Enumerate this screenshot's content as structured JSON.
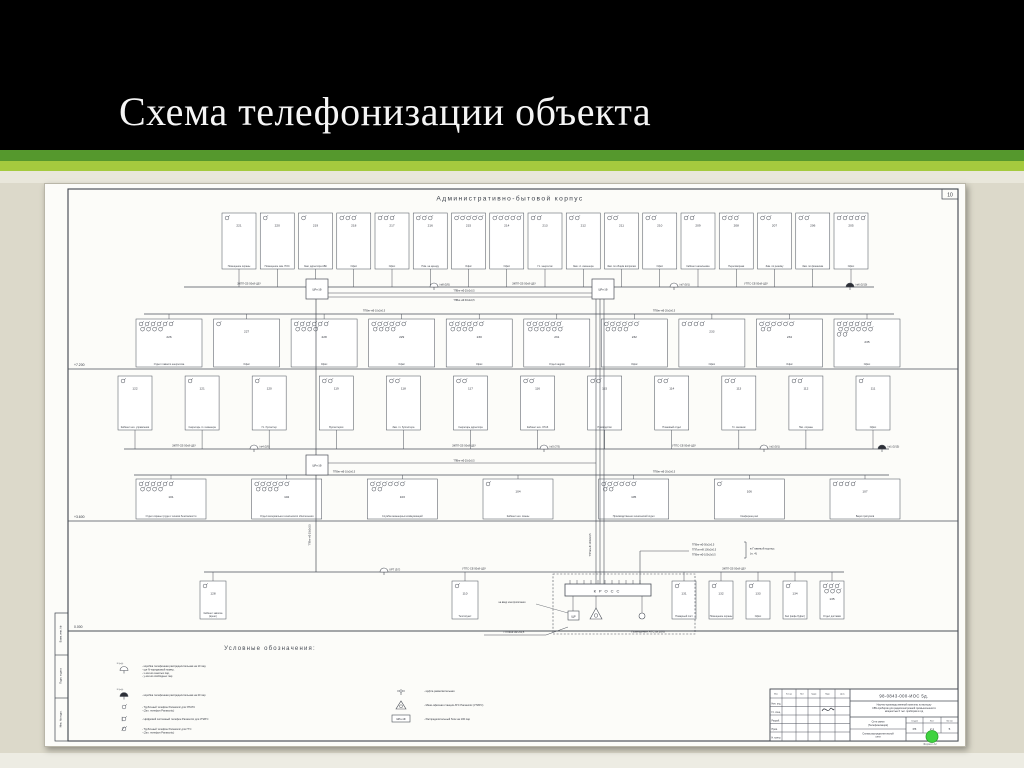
{
  "slide": {
    "title": "Схема телефонизации объекта"
  },
  "colors": {
    "header_bg": "#000000",
    "stripe_dark": "#55982d",
    "stripe_light": "#a5ca3e",
    "slide_bg": "#dcd9ca",
    "sheet_bg": "#fcfcf9",
    "line": "#474d56",
    "logo_green": "#3fd23f"
  },
  "sheet": {
    "corner_number": "10",
    "building_title": "Административно-бытовой корпус",
    "levels": [
      "+7.200",
      "+3.600",
      "0.000"
    ],
    "risers": {
      "cabinet": "ШРн-1Ф",
      "cable_left": "ТПВнг-нФ 30х2х0,5",
      "cable_center": "ТППэп-нФ 100х2х0,5",
      "floor_links": [
        "ТПВнг-нФ 20х2х0,5",
        "ТПВнг-нФ 30х2х0,5"
      ]
    },
    "floor2": {
      "row_top": [
        {
          "num": "221",
          "label": "Помещение охраны",
          "phones": 1
        },
        {
          "num": "220",
          "label": "Помещение зам. НОС",
          "phones": 1
        },
        {
          "num": "219",
          "label": "Зам. директора АБК",
          "phones": 1
        },
        {
          "num": "218",
          "label": "Офис",
          "phones": 3
        },
        {
          "num": "217",
          "label": "Офис",
          "phones": 3
        },
        {
          "num": "216",
          "label": "Пом. на аренду",
          "phones": 3
        },
        {
          "num": "215",
          "label": "Офис",
          "phones": 5
        },
        {
          "num": "214",
          "label": "Офис",
          "phones": 5
        },
        {
          "num": "213",
          "label": "Гл. энергетик",
          "phones": 2
        },
        {
          "num": "212",
          "label": "Зам. гл. инженера",
          "phones": 2
        },
        {
          "num": "211",
          "label": "Зам. по общим вопросам",
          "phones": 2
        },
        {
          "num": "210",
          "label": "Офис",
          "phones": 2
        },
        {
          "num": "209",
          "label": "Кабинет начальника",
          "phones": 2
        },
        {
          "num": "208",
          "label": "Переговорная",
          "phones": 3
        },
        {
          "num": "207",
          "label": "Зам. по режиму",
          "phones": 2
        },
        {
          "num": "206",
          "label": "Зам. по финансам",
          "phones": 2
        },
        {
          "num": "205",
          "label": "Офис",
          "phones": 5
        }
      ],
      "row_bottom": [
        {
          "num": "226",
          "label": "Отдел главного энергетика",
          "phones": 10
        },
        {
          "num": "227",
          "label": "Офис",
          "phones": 1
        },
        {
          "num": "228",
          "label": "Офис",
          "phones": 10
        },
        {
          "num": "229",
          "label": "Офис",
          "phones": 10
        },
        {
          "num": "230",
          "label": "Офис",
          "phones": 10
        },
        {
          "num": "231",
          "label": "Отдел кадров",
          "phones": 12
        },
        {
          "num": "232",
          "label": "Офис",
          "phones": 10
        },
        {
          "num": "233",
          "label": "Офис",
          "phones": 4
        },
        {
          "num": "234",
          "label": "Офис",
          "phones": 8
        },
        {
          "num": "235",
          "label": "Офис",
          "phones": 14
        }
      ],
      "taps": [
        "№8 (5/5)",
        "№7 (9/1)",
        "№6 (5/10)"
      ],
      "bus_labels": [
        "ЗКПП-СЕ-50х8-ЦЗУ",
        "ЗКПП-СЕ-50х8-ЦЗУ",
        "УТПС-СЕ-50х8-ЦЗУ"
      ],
      "feeder_labels": [
        "ТПВнг-нФ 10х2х0,5",
        "ТПВнг-нФ 20х2х0,5"
      ]
    },
    "floor1": {
      "row_top": [
        {
          "num": "122",
          "label": "Кабинет нач. управления",
          "phones": 1
        },
        {
          "num": "121",
          "label": "Секретарь гл. инженера",
          "phones": 1
        },
        {
          "num": "120",
          "label": "Гл. бухгалтер",
          "phones": 1
        },
        {
          "num": "119",
          "label": "Бухгалтерия",
          "phones": 2
        },
        {
          "num": "118",
          "label": "Зам. гл. бухгалтера",
          "phones": 2
        },
        {
          "num": "117",
          "label": "Секретарь директора",
          "phones": 2
        },
        {
          "num": "116",
          "label": "Кабинет нач. ОТиЗ",
          "phones": 2
        },
        {
          "num": "115",
          "label": "Руководство",
          "phones": 2
        },
        {
          "num": "114",
          "label": "Плановый отдел",
          "phones": 2
        },
        {
          "num": "113",
          "label": "Гл. механик",
          "phones": 2
        },
        {
          "num": "112",
          "label": "Нач. охраны",
          "phones": 2
        },
        {
          "num": "111",
          "label": "Офис",
          "phones": 1
        }
      ],
      "row_bottom": [
        {
          "num": "101",
          "label": "Отдел охраны труда и техники безопасности",
          "phones": 10
        },
        {
          "num": "102",
          "label": "Отдел материально-технического обеспечения",
          "phones": 10
        },
        {
          "num": "103",
          "label": "Служба инженерных коммуникаций",
          "phones": 8
        },
        {
          "num": "104",
          "label": "Кабинет нач. смены",
          "phones": 1
        },
        {
          "num": "105",
          "label": "Производственно-технический отдел",
          "phones": 8
        },
        {
          "num": "106",
          "label": "Конференц-зал",
          "phones": 1
        },
        {
          "num": "107",
          "label": "Бюро пропусков",
          "phones": 4
        }
      ],
      "taps": [
        "№4 (5/5)",
        "№3 (7/3)",
        "№2 (9/1)",
        "№1 (5/15)"
      ],
      "bus_labels": [
        "ЗКПП-СЕ-50х8-ЦЗУ",
        "ЗКПП-СЕ-50х8-ЦЗУ",
        "УТПС-СЕ-50х8-ЦЗУ"
      ],
      "feeder_labels": [
        "ТПВнг-нФ 10х2х0,5",
        "ТПВнг-нФ 20х2х0,5"
      ]
    },
    "ground": {
      "row_left": [
        {
          "num": "128",
          "label": "Кабинет завхоза (врем.)",
          "phones": 1
        },
        {
          "num": "110",
          "label": "Теплопункт",
          "phones": 1
        }
      ],
      "row_right": [
        {
          "num": "131",
          "label": "Пожарный пост",
          "phones": 1
        },
        {
          "num": "132",
          "label": "Помещение охраны",
          "phones": 1
        },
        {
          "num": "133",
          "label": "Офис",
          "phones": 1
        },
        {
          "num": "134",
          "label": "Зал (кафе-буфет)",
          "phones": 1
        },
        {
          "num": "135",
          "label": "Отдел доставки",
          "phones": 6
        }
      ],
      "bus_labels": [
        "УТПС-СЕ-50х8-ЦЗУ",
        "ЗКПП-СЕ-50х8-ЦЗУ"
      ],
      "tap": "КРТ (3/7)"
    },
    "cross": {
      "label": "КРОСС",
      "room": "Помещение АТС (в.106)",
      "panel": "ЩР",
      "entry_cable": "ПТПЖнг-нФ 2х0,5",
      "entry_note": "на ввод электропитания",
      "to_main_cables": [
        "ТПВнг-нФ 50х2х0,5",
        "ТППэп-нФ 100х2х0,5",
        "ТПВнг-нФ 100х2х0,5"
      ],
      "to_main_dest": "в Главный корпус (п. 4)"
    },
    "legend": {
      "title": "Условные обозначения:",
      "left": [
        {
          "sym": "krt-10",
          "tag": "N (х/у)",
          "lines": [
            "коробка телефонная распределительная на 10 пар,",
            "где N-порядковый номер,",
            "х-кол-во занятых пар,",
            "у-кол-во свободных пар"
          ]
        },
        {
          "sym": "krt-20",
          "tag": "N (х/у)",
          "lines": [
            "коробка телефонная распределительная на 20 пар"
          ]
        },
        {
          "sym": "phone-upats",
          "lines": [
            "Трубочный телефон Panasonic для УПАТС",
            "(2кл. телефон Panasonic)"
          ]
        },
        {
          "sym": "phone-digital",
          "lines": [
            "Цифровой системный телефон Panasonic для УПАТС"
          ]
        },
        {
          "sym": "phone-gts",
          "lines": [
            "Трубочный телефон Panasonic для ГТС",
            "(2кл. телефон Panasonic)"
          ]
        }
      ],
      "right": [
        {
          "sym": "mufta",
          "lines": [
            "муфта разветвительная"
          ]
        },
        {
          "sym": "ats-triangle",
          "lines": [
            "Мини-офисная станция АТС Panasonic (УПАТС)"
          ]
        },
        {
          "sym": "shrn-box",
          "tag": "ШРн-1Ф",
          "lines": [
            "Распределительный блок на 100 пар"
          ]
        }
      ]
    },
    "titleblock": {
      "doc_number": "98-0843-000-ИОС 5д.",
      "project": "Научно-производственный комплекс по выпуску СВЧ-приборов для радиоэлектронной промышленности мощностью 6 тыс. приборов в год",
      "section": "Сети связи (Телефонизация)",
      "drawing_name": "Схема распределительной сети",
      "stage_label": "Стадия",
      "stage": "РЗ",
      "sheet_label": "Лист",
      "sheet_num": "2.1",
      "sheets_label": "Листов",
      "sheets_total": "5",
      "header_cols": [
        "Изм.",
        "Кол.уч",
        "Лист",
        "№док.",
        "Подп.",
        "Дата"
      ],
      "roles": [
        "Нач. отд.",
        "Гл. спец.",
        "Разраб.",
        "Пров.",
        "Н. контр."
      ],
      "format_note": "Формат А2"
    },
    "margin_stamp": [
      "Взам. инв. №",
      "Подп. и дата",
      "Инв. № подл."
    ]
  }
}
